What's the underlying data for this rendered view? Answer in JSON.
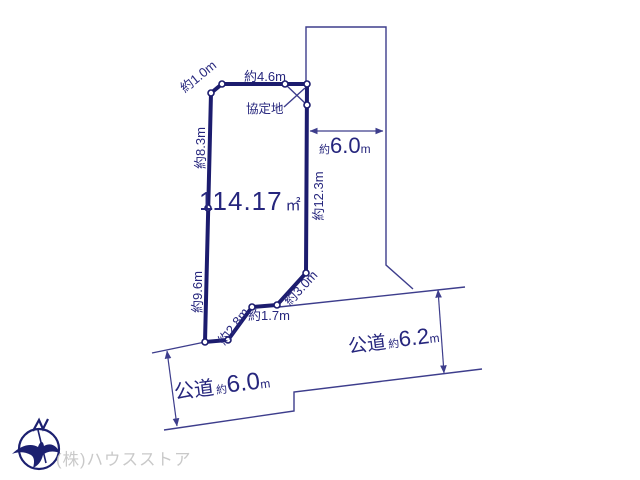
{
  "plot": {
    "area_value": "114.17",
    "area_unit": "㎡",
    "agreement_label": "協定地"
  },
  "dimensions": {
    "chamfer": "約1.0m",
    "top": "約4.6m",
    "left_upper": "約8.3m",
    "left_lower": "約9.6m",
    "right_side": "約12.3m",
    "bottom_diag_left": "約2.8m",
    "bottom_middle": "約1.7m",
    "bottom_diag_right": "約3.0m"
  },
  "east_setback": {
    "approx": "約",
    "value": "6.0",
    "unit": "m"
  },
  "roads": {
    "left": {
      "name": "公道",
      "approx": "約",
      "value": "6.0",
      "unit": "m"
    },
    "right": {
      "name": "公道",
      "approx": "約",
      "value": "6.2",
      "unit": "m"
    }
  },
  "compass": {
    "north_label": "N"
  },
  "watermark": "(株)ハウスストア",
  "colors": {
    "plot_fill": "#f8d79c",
    "plot_border": "#1c1c6e",
    "line": "#3d3d8c",
    "text": "#26267d",
    "watermark": "#c9c9c9",
    "background": "#ffffff"
  }
}
